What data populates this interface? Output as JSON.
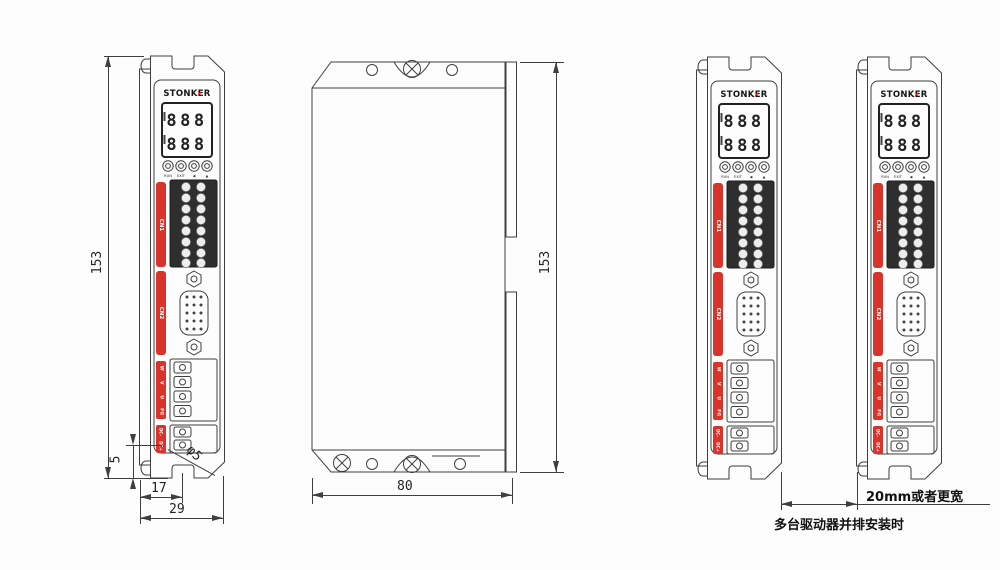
{
  "drawing": {
    "colors": {
      "accent_red": "#d9342b",
      "line": "#3f3f3f",
      "block_dark": "#2e2e2e"
    }
  },
  "device": {
    "brand": "STONKER",
    "logo_mark": "✕",
    "display_rows": [
      "888",
      "888"
    ],
    "buttons": [
      "RUN",
      "EXIT",
      "◀",
      "▲"
    ],
    "connectors": {
      "cn1": "CN1",
      "cn2": "CN2"
    },
    "motor_terminals": [
      "W",
      "V",
      "U",
      "FG"
    ],
    "dc_terminals": [
      "DC-",
      "DC+"
    ]
  },
  "dimensions": {
    "side_height_mm": "153",
    "front_height_mm": "153",
    "front_width_mm": "80",
    "mount_offset_mm": "5",
    "mount_width_mm": "17",
    "total_depth_mm": "29",
    "mount_hole": "φ5",
    "spacing_note": "20mm或者更宽",
    "spacing_caption": "多台驱动器并排安装时"
  }
}
